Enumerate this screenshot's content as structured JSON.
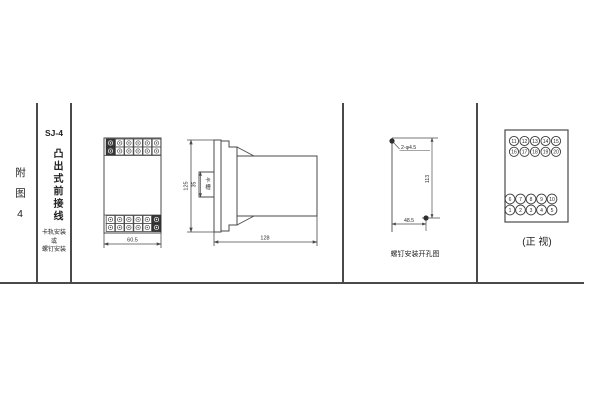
{
  "page": {
    "bg": "#ffffff",
    "line_color": "#4a4a4a"
  },
  "sidebar": {
    "figure_label": "附图4",
    "model": "SJ-4",
    "type_label": "凸出式前接线",
    "mount_lines": [
      "卡轨安装",
      "或",
      "螺钉安装"
    ]
  },
  "front_view": {
    "width_dim": "60.5"
  },
  "side_view": {
    "height_dim": "125",
    "slot_dim": "35",
    "slot_chars": [
      "卡",
      "槽"
    ],
    "depth_dim": "128"
  },
  "drill_view": {
    "hole_label": "2-φ4.5",
    "height_dim": "113",
    "width_dim": "48.5",
    "caption": "螺钉安装开孔图"
  },
  "terminal_view": {
    "rows": [
      [
        "11",
        "12",
        "13",
        "14",
        "15"
      ],
      [
        "16",
        "17",
        "18",
        "19",
        "20"
      ],
      [
        "6",
        "7",
        "8",
        "9",
        "10"
      ],
      [
        "1",
        "2",
        "3",
        "4",
        "5"
      ]
    ],
    "caption": "(正 视)"
  }
}
